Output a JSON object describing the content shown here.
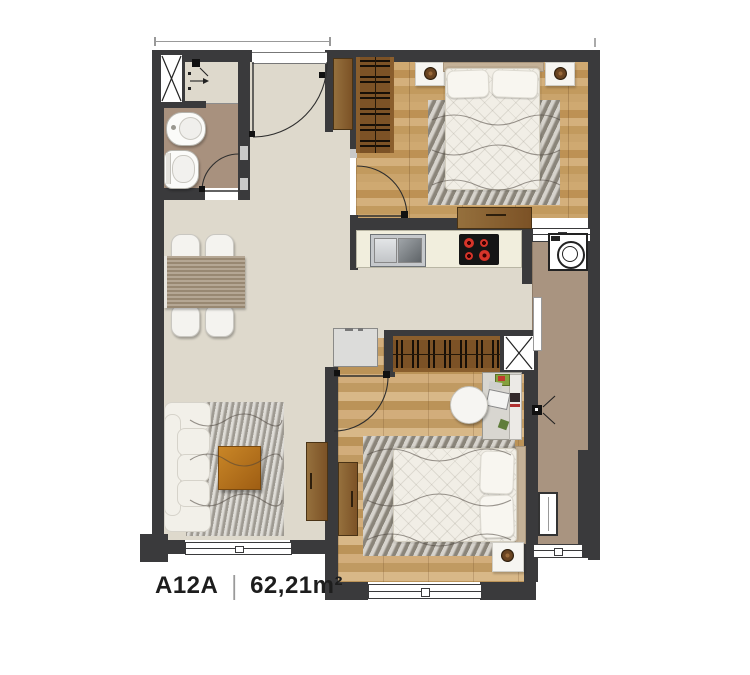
{
  "unit": {
    "code": "A12A",
    "separator": "|",
    "area": "62,21m²"
  },
  "palette": {
    "wall": "#3a3a3c",
    "floor_main": "#ded9cc",
    "floor_bathroom": "#a8917e",
    "floor_balcony": "#a99480",
    "floor_wood": "#c6a066",
    "furniture_wood": "#8a6134",
    "coffee_table": "#b9761f",
    "kitchen_counter": "#f1eedd",
    "burner_red": "#c2261f"
  },
  "icons": {
    "shaft": "x-cross-shaft-icon",
    "drain": "floor-drain-icon",
    "washer": "washing-machine-icon",
    "cooktop": "cooktop-icon",
    "kitchen_sink": "kitchen-sink-icon",
    "door_swing": "door-swing-arc-icon"
  }
}
